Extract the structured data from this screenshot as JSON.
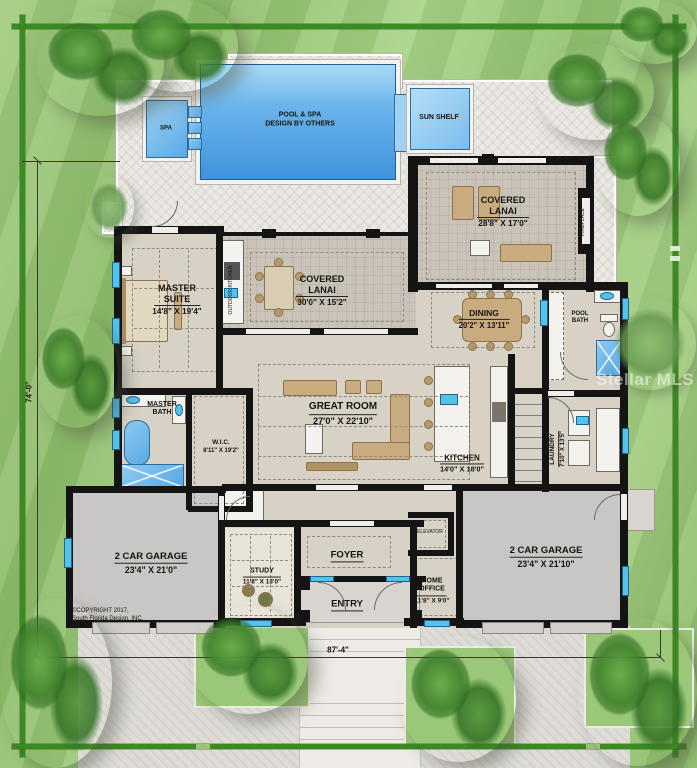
{
  "site": {
    "dim_left": "74'-0\"",
    "dim_bottom": "87'-4\"",
    "copyright1": "©COPYRIGHT 2017,",
    "copyright2": "South Florida Design, INC.",
    "watermark": "Stellar MLS"
  },
  "outdoor": {
    "pool1": "POOL & SPA",
    "pool2": "DESIGN BY OTHERS",
    "spa": "SPA",
    "sun_shelf": "SUN SHELF",
    "outdoor_kitchen": "OUTDOOR KITCHEN",
    "fireplace": "FIREPLACE"
  },
  "rooms": {
    "lanai_right": {
      "name": "COVERED LANAI",
      "dims": "28'8\" X 17'0\""
    },
    "lanai_center": {
      "name": "COVERED LANAI",
      "dims": "30'0\" X 15'2\""
    },
    "master_suite": {
      "name": "MASTER SUITE",
      "dims": "14'8\" X 19'4\""
    },
    "dining": {
      "name": "DINING",
      "dims": "20'2\" X 13'11\""
    },
    "great_room": {
      "name": "GREAT ROOM",
      "dims": "27'0\" X 22'10\""
    },
    "kitchen": {
      "name": "KITCHEN",
      "dims": "14'0\" X 18'0\""
    },
    "laundry": {
      "name": "LAUNDRY",
      "dims": "7'10\" X 13'5\""
    },
    "pool_bath": {
      "name": "POOL BATH"
    },
    "master_bath": {
      "name": "MASTER BATH"
    },
    "wic": {
      "name": "W.I.C.",
      "dims": "8'11\" X 19'2\""
    },
    "garage_left": {
      "name": "2 CAR GARAGE",
      "dims": "23'4\" X 21'0\""
    },
    "garage_right": {
      "name": "2 CAR GARAGE",
      "dims": "23'4\" X 21'10\""
    },
    "study": {
      "name": "STUDY",
      "dims": "11'8\" X 13'0\""
    },
    "foyer": {
      "name": "FOYER"
    },
    "entry": {
      "name": "ENTRY"
    },
    "home_office": {
      "name": "HOME OFFICE",
      "dims": "11'8\" X 9'0\""
    },
    "elevator": {
      "name": "ELEVATOR"
    }
  },
  "colors": {
    "lawn": "#97c474",
    "boundary": "#3c8a22",
    "pool_blue": "#4d9fe2",
    "deck": "#ebe8e3",
    "wall": "#141414",
    "window_cyan": "#55c2ec",
    "floor": "#d7d1c6",
    "paver": "#c9c3ba",
    "garage_floor": "#c9c7c5",
    "furniture_tan": "#c8ac80"
  }
}
